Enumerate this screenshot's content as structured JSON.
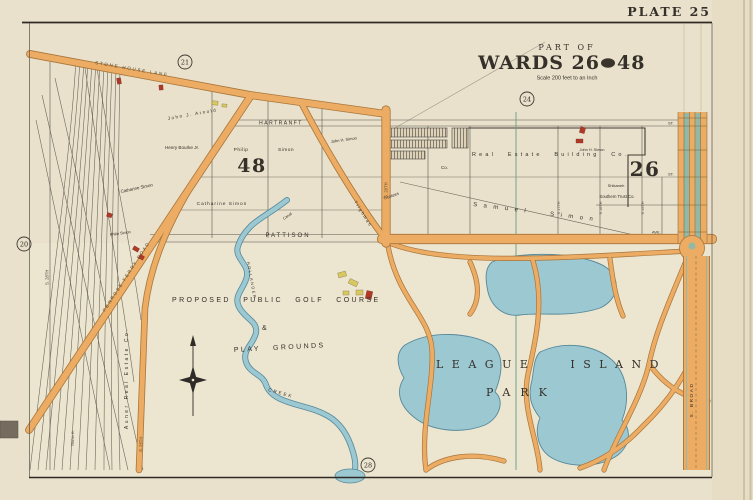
{
  "palette": {
    "paper": "#e9e1cb",
    "margin": "#e6ddc4",
    "park-paper": "#ece5cf",
    "road": "#ecac63",
    "road-edge": "#a8753a",
    "road-text": "#5d4a28",
    "water": "#9cc8d2",
    "water-edge": "#55899b",
    "median": "#92b9a7",
    "ward-line": "#69a287",
    "ink": "#35302a",
    "line": "#5b564e",
    "heavy": "#423c34",
    "red-bldg": "#b03a28",
    "yellow-bldg": "#d9c763",
    "tab": "#756c5f",
    "page-edge": "#bcb093"
  },
  "header": {
    "plate_label": "PLATE 25"
  },
  "title_block": {
    "part_of": "PART OF",
    "wards_left": "WARDS 26",
    "and_label": "AND",
    "wards_right": "48",
    "scale": "Scale 200 feet to an Inch"
  },
  "plate_refs": {
    "top_left": "21",
    "top_center": "24",
    "west": "20",
    "south": "28"
  },
  "wards": {
    "west_number": "48",
    "east_number": "26"
  },
  "streets": {
    "hartranft": "HARTRANFT",
    "st": "ST.",
    "pattison": "PATTISON",
    "ave": "AVE.",
    "stone_house_lane": "STONE HOUSE LANE",
    "penrose_ferry": "PENROSE FERRY ROAD",
    "s_broad": "S. BROAD",
    "s26": "S. 26TH",
    "s28": "S. 28TH",
    "s20": "S. 20TH",
    "s15": "S 15TH",
    "s16": "S 16TH",
    "s17": "S 17TH"
  },
  "owners": {
    "philip": "Philip",
    "simon": "Simon",
    "philip_simon_small": "Philip Simon",
    "henry_bourke": "Henry Bourke Jr.",
    "catharine_simon": "Catharine Simon",
    "john_arnold": "John J. Arnold",
    "john_h_simon": "John H. Simon",
    "real_estate_co": "Real Estate Building Co.",
    "samuel_simon": "Samuel Simon",
    "southern_trust": "Southern Trust Co.",
    "shikaneh": "Shikaneh",
    "auner": "Auner Real Estate Co.",
    "trustees": "Trustees",
    "co": "Co.",
    "tilghman": "Tilghman",
    "canal": "Canal"
  },
  "park": {
    "league_island": "LEAGUE ISLAND",
    "park": "PARK",
    "proposed": "PROPOSED PUBLIC GOLF COURSE",
    "amp": "&",
    "play_grounds": "PLAY GROUNDS",
    "creek": "CREEK",
    "creek_name": "HOLLANDER"
  },
  "railroad": {
    "maher": "Maher R."
  }
}
